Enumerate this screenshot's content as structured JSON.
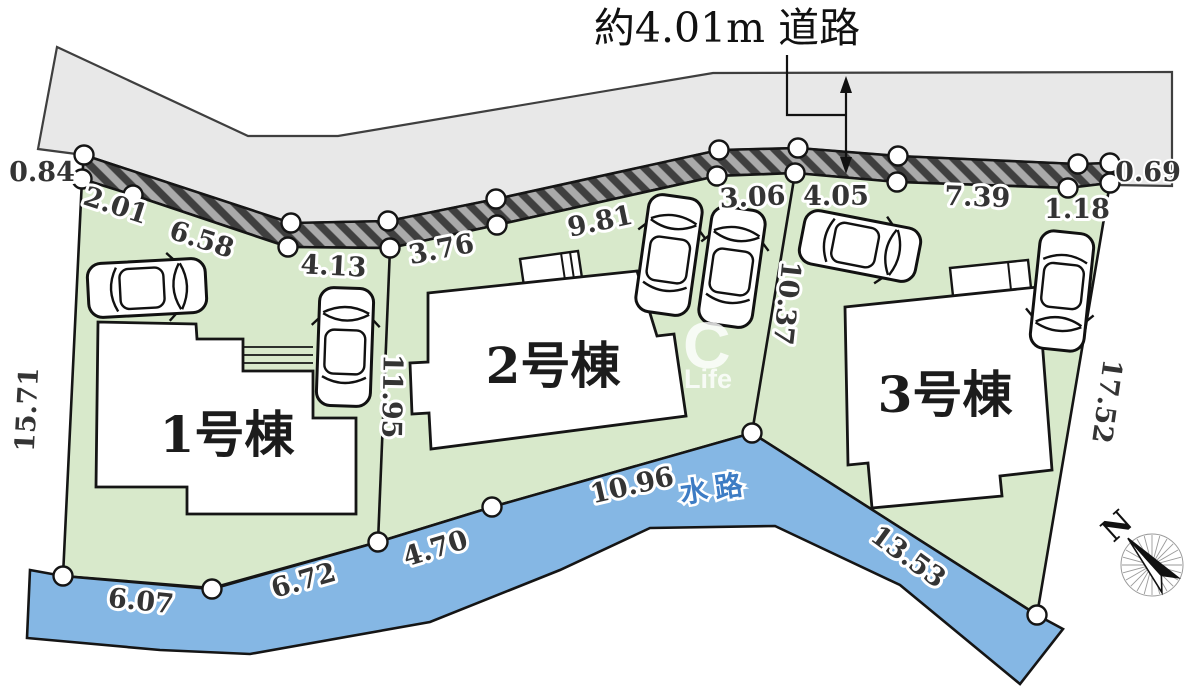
{
  "plan": {
    "road_label": "約4.01m 道路",
    "waterway_label": "水路",
    "compass_north": "N",
    "watermark": {
      "letter": "C",
      "word": "Life"
    },
    "lots": [
      {
        "label": "1号棟"
      },
      {
        "label": "2号棟"
      },
      {
        "label": "3号棟"
      }
    ],
    "dimensions": {
      "frontage": [
        "0.84",
        "2.01",
        "6.58",
        "4.13",
        "3.76",
        "9.81",
        "3.06",
        "4.05",
        "7.39",
        "1.18",
        "0.69"
      ],
      "left_edge": "15.71",
      "boundary_1_2": "11.95",
      "boundary_2_3": "10.37",
      "right_edge": "17.52",
      "waterway": [
        "6.07",
        "6.72",
        "4.70",
        "10.96",
        "13.53"
      ]
    },
    "colors": {
      "road": "#e8e8e8",
      "road_edge": "#3f3f3f",
      "hatch_base": "#aaaaaa",
      "hatch_dark": "#3f3f3f",
      "lot_green": "#d8e9cb",
      "water_blue": "#85b7e4",
      "outline": "#151515",
      "water_text": "#3d7cc4"
    }
  }
}
